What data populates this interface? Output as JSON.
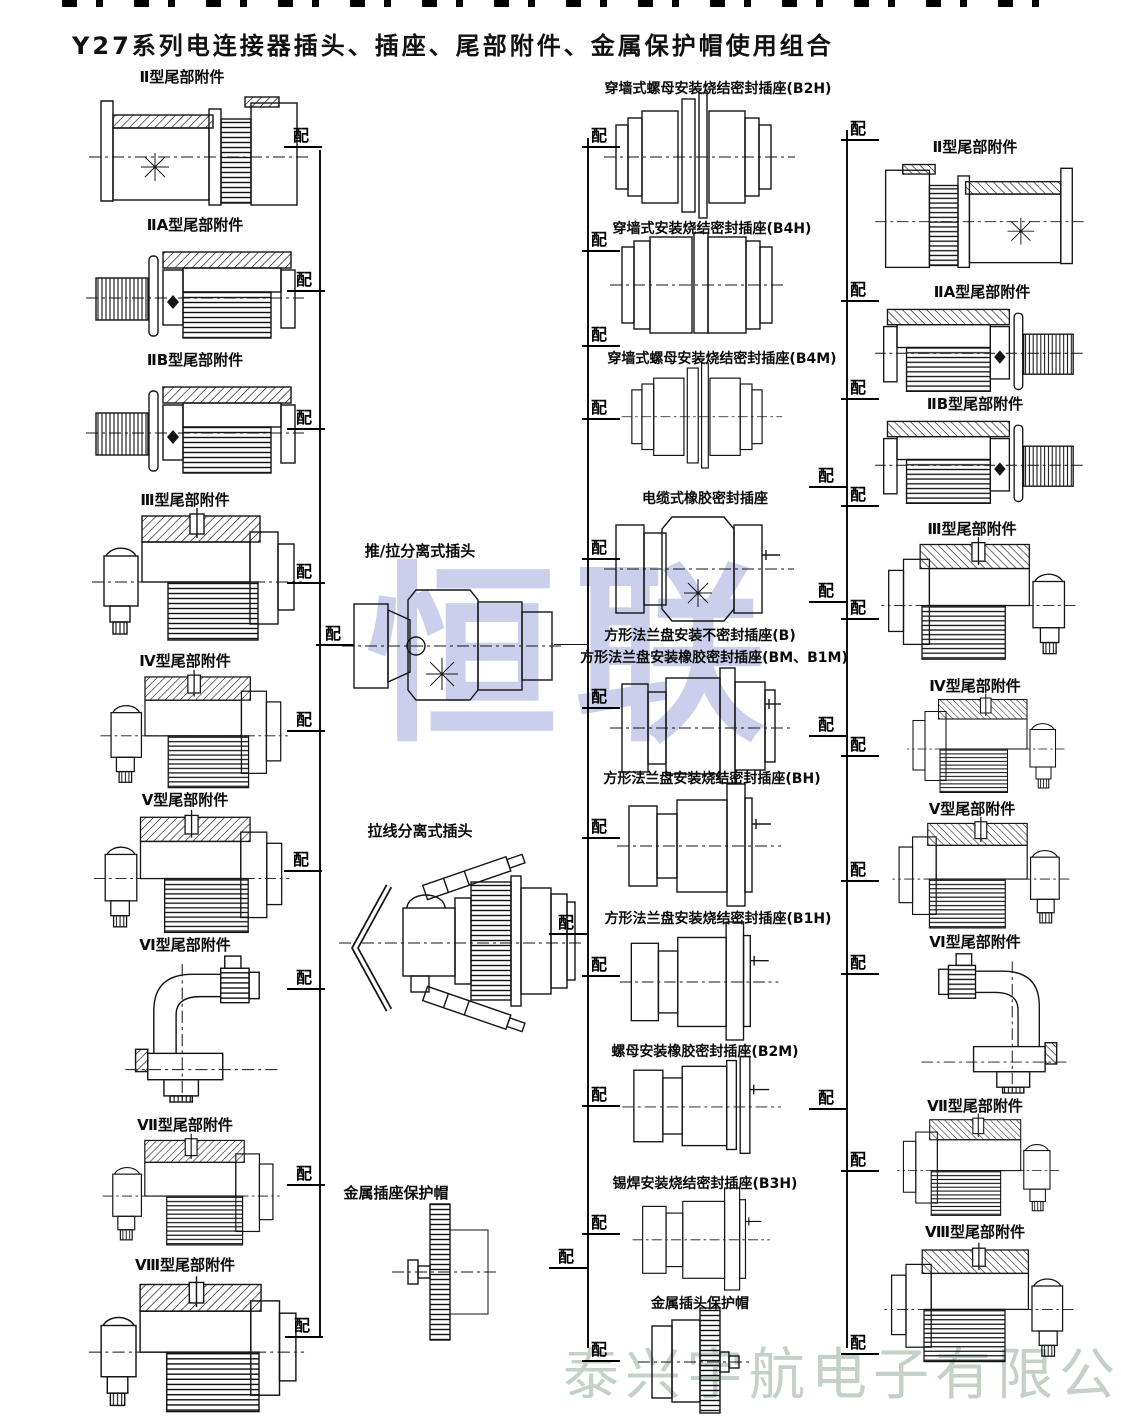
{
  "title": "Y27系列电连接器插头、插座、尾部附件、金属保护帽使用组合",
  "labels": {
    "match": "配"
  },
  "watermarks": {
    "center": "恒联",
    "bottom": "泰兴宇航电子有限公司"
  },
  "left_column": {
    "items": [
      {
        "label": "Ⅱ型尾部附件"
      },
      {
        "label": "ⅡA型尾部附件"
      },
      {
        "label": "ⅡB型尾部附件"
      },
      {
        "label": "Ⅲ型尾部附件"
      },
      {
        "label": "Ⅳ型尾部附件"
      },
      {
        "label": "Ⅴ型尾部附件"
      },
      {
        "label": "Ⅵ型尾部附件"
      },
      {
        "label": "Ⅶ型尾部附件"
      },
      {
        "label": "Ⅷ型尾部附件"
      }
    ]
  },
  "middle_column": {
    "items": [
      {
        "label": "推/拉分离式插头"
      },
      {
        "label": "拉线分离式插头"
      },
      {
        "label": "金属插座保护帽"
      }
    ]
  },
  "socket_column": {
    "items": [
      {
        "label": "穿墙式螺母安装烧结密封插座(B2H)"
      },
      {
        "label": "穿墙式安装烧结密封插座(B4H)"
      },
      {
        "label": "穿墙式螺母安装烧结密封插座(B4M)"
      },
      {
        "label": "电缆式橡胶密封插座"
      },
      {
        "label": "方形法兰盘安装不密封插座(B)",
        "label2": "方形法兰盘安装橡胶密封插座(BM、B1M)"
      },
      {
        "label": "方形法兰盘安装烧结密封插座(BH)"
      },
      {
        "label": "方形法兰盘安装烧结密封插座(B1H)"
      },
      {
        "label": "螺母安装橡胶密封插座(B2M)"
      },
      {
        "label": "锡焊安装烧结密封插座(B3H)"
      },
      {
        "label": "金属插头保护帽"
      }
    ]
  },
  "right_column": {
    "items": [
      {
        "label": "Ⅱ型尾部附件"
      },
      {
        "label": "ⅡA型尾部附件"
      },
      {
        "label": "ⅡB型尾部附件"
      },
      {
        "label": "Ⅲ型尾部附件"
      },
      {
        "label": "Ⅳ型尾部附件"
      },
      {
        "label": "Ⅴ型尾部附件"
      },
      {
        "label": "Ⅵ型尾部附件"
      },
      {
        "label": "Ⅶ型尾部附件"
      },
      {
        "label": "Ⅷ型尾部附件"
      }
    ]
  }
}
